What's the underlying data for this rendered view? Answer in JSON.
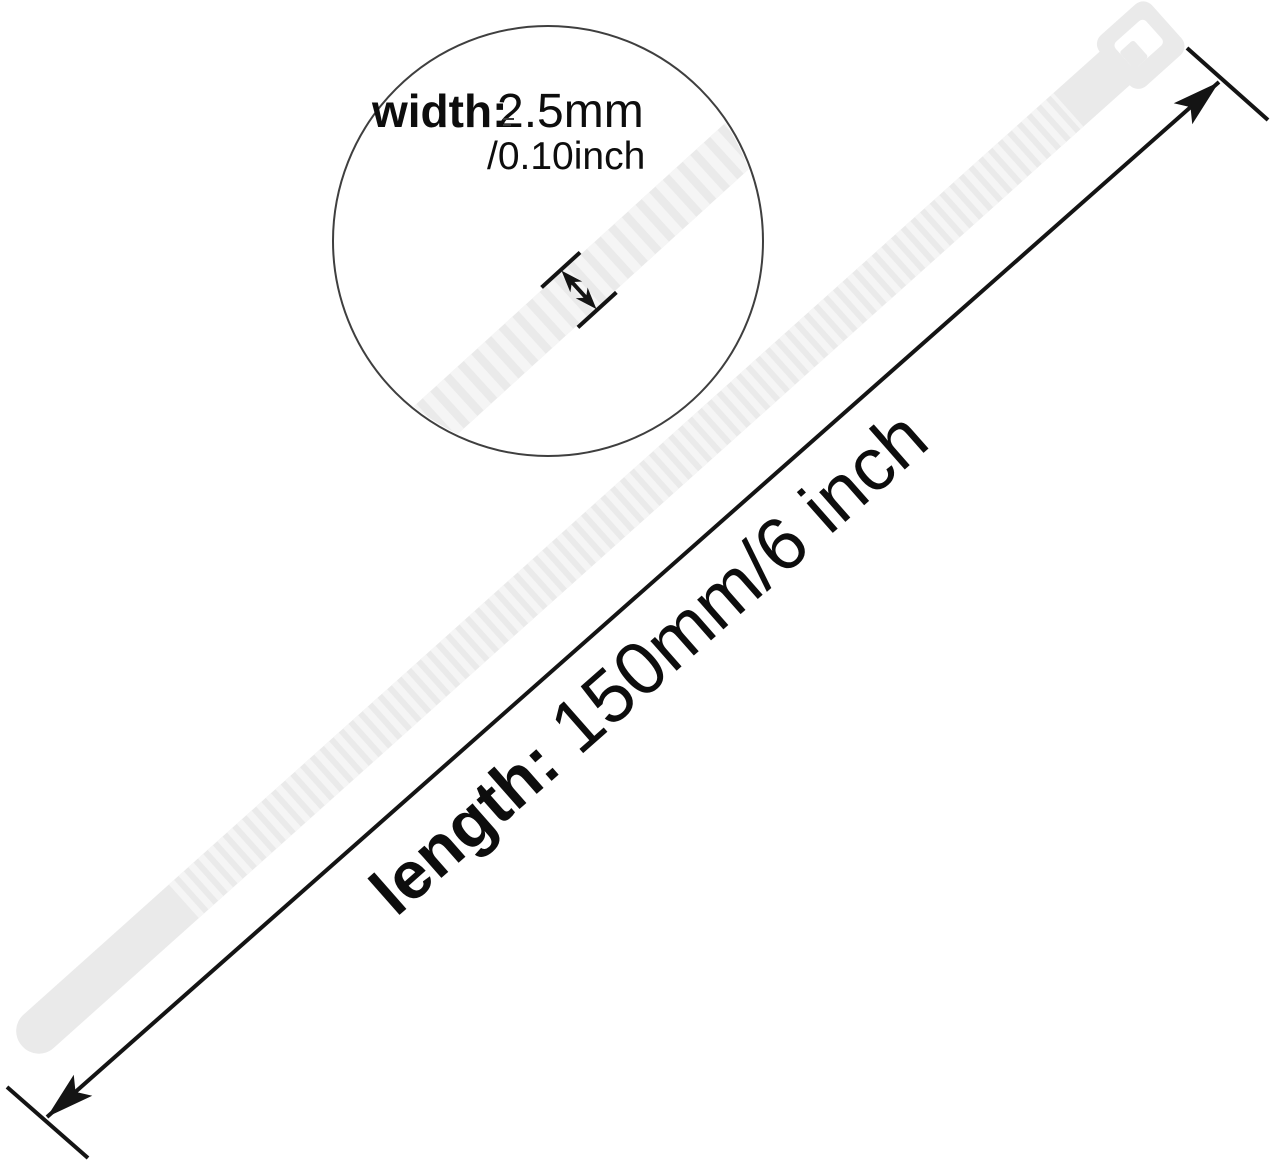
{
  "scene": {
    "description": "White nylon cable zip tie shown diagonally with a magnifier circle calling out band width and a parallel dimension line calling out overall length"
  },
  "magnifier": {
    "width_label": "width:",
    "width_value_mm": "2.5mm",
    "width_value_inch": "/0.10inch"
  },
  "length_dimension": {
    "label": "length:",
    "value": "150mm/6 inch"
  },
  "colors": {
    "background": "#ffffff",
    "tie_fill": "#eaeaea",
    "tie_rib": "#f5f5f5",
    "slot": "#ffffff",
    "line": "#141414",
    "circle_stroke": "#3f3f3f",
    "text": "#0d0d0d"
  }
}
